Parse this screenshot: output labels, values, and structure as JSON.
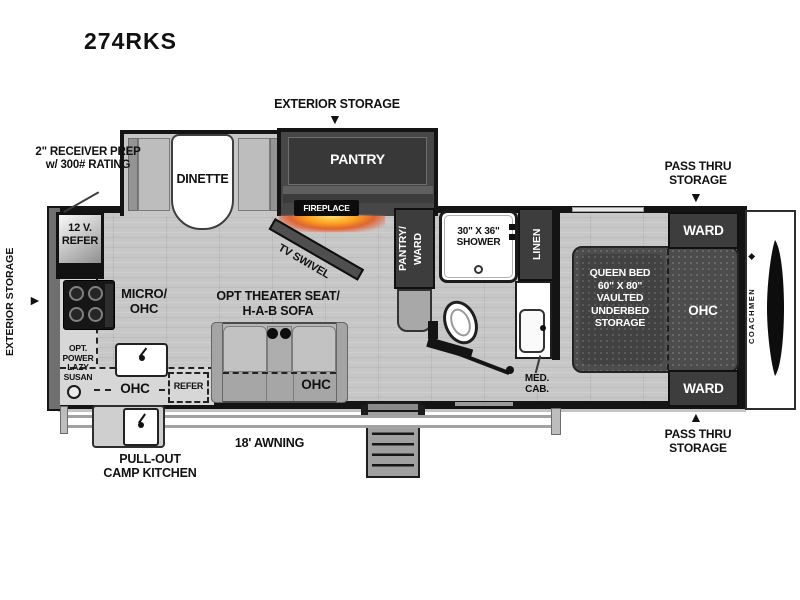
{
  "title": "274RKS",
  "icons": {
    "arrow_down": "▼",
    "arrow_up": "▲",
    "arrow_right": "►",
    "logo_glyph": "◆"
  },
  "callouts": {
    "exterior_storage_top": "EXTERIOR STORAGE",
    "exterior_storage_left": "EXTERIOR STORAGE",
    "receiver_line1": "2\" RECEIVER PREP",
    "receiver_line2": "w/ 300# RATING",
    "pass_thru_line1": "PASS THRU",
    "pass_thru_line2": "STORAGE",
    "awning": "18' AWNING",
    "camp_kitchen_line1": "PULL-OUT",
    "camp_kitchen_line2": "CAMP KITCHEN",
    "med_cab_line1": "MED.",
    "med_cab_line2": "CAB."
  },
  "rooms": {
    "dinette": "DINETTE",
    "pantry": "PANTRY",
    "fireplace": "FIREPLACE",
    "tv_swivel": "TV SWIVEL",
    "pantry_ward_line1": "PANTRY/",
    "pantry_ward_line2": "WARD",
    "refer12_line1": "12 V.",
    "refer12_line2": "REFER",
    "micro_line1": "MICRO/",
    "micro_line2": "OHC",
    "lazy_line1": "OPT.",
    "lazy_line2": "POWER",
    "lazy_line3": "LAZY",
    "lazy_line4": "SUSAN",
    "kitchen_ohc": "OHC",
    "kitchen_refer": "REFER",
    "theater_line1": "OPT THEATER SEAT/",
    "theater_line2": "H-A-B SOFA",
    "sofa_ohc": "OHC",
    "shower_line1": "30\" X 36\"",
    "shower_line2": "SHOWER",
    "linen": "LINEN",
    "ward_top": "WARD",
    "ward_bottom": "WARD",
    "bed_line1": "QUEEN BED",
    "bed_line2": "60\" X 80\"",
    "bed_line3": "VAULTED",
    "bed_line4": "UNDERBED",
    "bed_line5": "STORAGE",
    "bed_ohc": "OHC",
    "brand": "COACHMEN"
  },
  "colors": {
    "wall": "#141414",
    "floor": "#c7c7c7",
    "cabinet_dark": "#3d3d3d",
    "fireplace_glow": "#ff9a1f"
  }
}
